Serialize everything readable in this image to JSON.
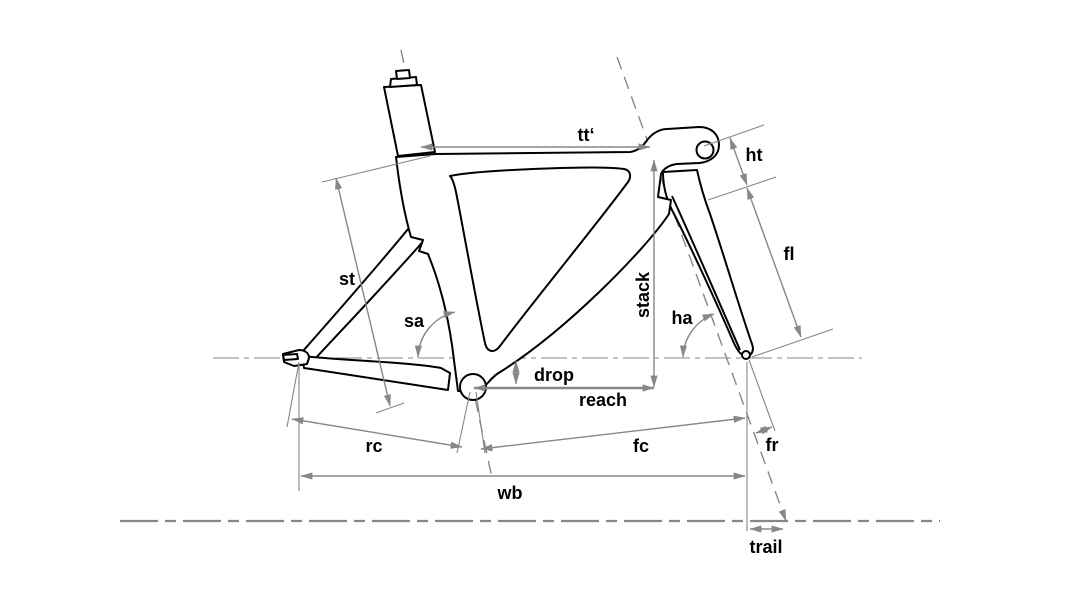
{
  "diagram": {
    "type": "technical-line-drawing",
    "subject": "bicycle-frame-geometry",
    "colors": {
      "outline": "#000000",
      "dimension": "#878787",
      "label": "#000000",
      "background": "#ffffff"
    },
    "labels": {
      "tt": "tt‘",
      "ht": "ht",
      "fl": "fl",
      "st": "st",
      "sa": "sa",
      "stack": "stack",
      "ha": "ha",
      "drop": "drop",
      "reach": "reach",
      "rc": "rc",
      "fc": "fc",
      "fr": "fr",
      "wb": "wb",
      "trail": "trail"
    }
  }
}
